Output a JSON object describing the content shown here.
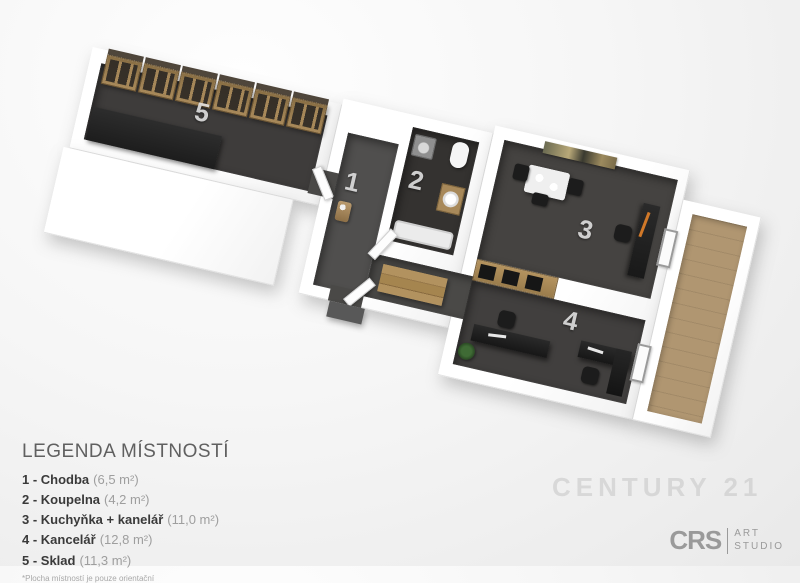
{
  "legend": {
    "title": "LEGENDA MÍSTNOSTÍ",
    "items": [
      {
        "label": "1 - Chodba",
        "area": "(6,5 m²)"
      },
      {
        "label": "2 - Koupelna",
        "area": "(4,2 m²)"
      },
      {
        "label": "3 - Kuchyňka + kanelář",
        "area": "(11,0 m²)"
      },
      {
        "label": "4 - Kancelář",
        "area": "(12,8 m²)"
      },
      {
        "label": "5 - Sklad",
        "area": "(11,3 m²)"
      }
    ],
    "footnote": "*Plocha místností je pouze orientační"
  },
  "floorplan": {
    "rooms": [
      {
        "number": "1",
        "name": "Chodba"
      },
      {
        "number": "2",
        "name": "Koupelna"
      },
      {
        "number": "3",
        "name": "Kuchyňka + kancelář"
      },
      {
        "number": "4",
        "name": "Kancelář"
      },
      {
        "number": "5",
        "name": "Sklad"
      }
    ],
    "colors": {
      "wall_white": "#ffffff",
      "floor_dark": "#3e3c3b",
      "floor_hall": "#504f4e",
      "balcony_wood": "#b09671",
      "shelf_wood": "#a8895a",
      "counter_black": "#222222",
      "background": "#f0f0f0",
      "room_number_text": "#ececec"
    }
  },
  "watermark": "CENTURY 21",
  "logo": {
    "brand": "CRS",
    "studio_line1": "ART",
    "studio_line2": "STUDIO"
  }
}
